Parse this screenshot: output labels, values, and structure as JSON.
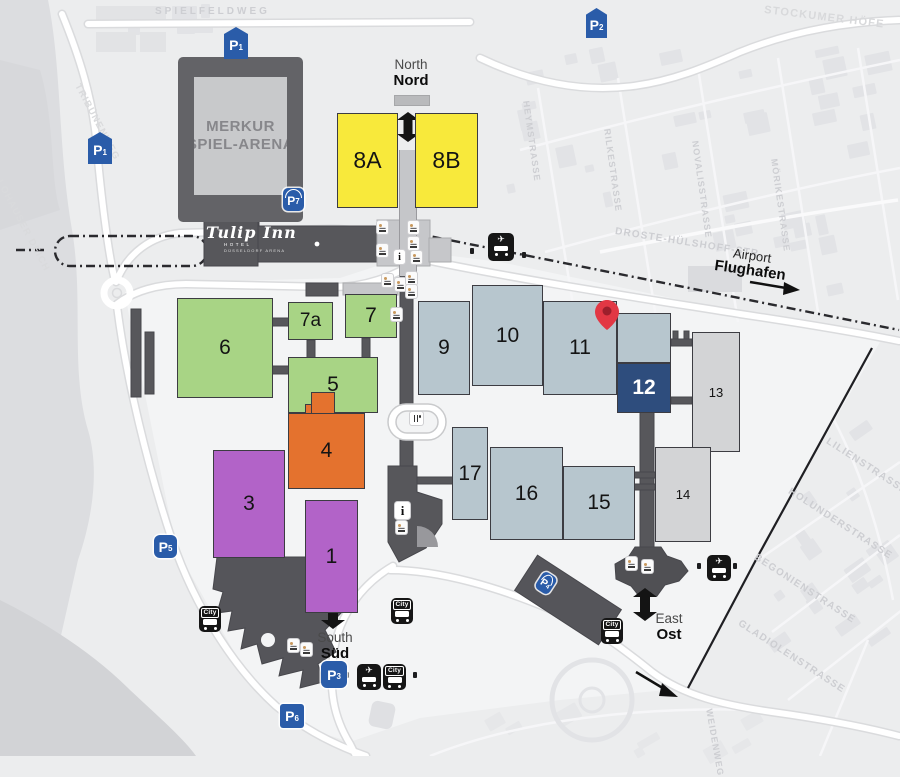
{
  "arena": {
    "line1": "MERKUR",
    "line2": "SPIEL-ARENA"
  },
  "hotel": {
    "name": "Tulip Inn",
    "line2": "HOTEL",
    "line3": "DÜSSELDORF ARENA"
  },
  "entrances": {
    "north": {
      "en": "North",
      "de": "Nord"
    },
    "south": {
      "en": "South",
      "de": "Süd"
    },
    "east": {
      "en": "East",
      "de": "Ost"
    }
  },
  "airport": {
    "en": "Airport",
    "de": "Flughafen"
  },
  "halls": [
    {
      "id": "hall-1",
      "label": "1",
      "color": "purple"
    },
    {
      "id": "hall-3",
      "label": "3",
      "color": "purple"
    },
    {
      "id": "hall-4",
      "label": "4",
      "color": "orange"
    },
    {
      "id": "hall-5",
      "label": "5",
      "color": "green"
    },
    {
      "id": "hall-6",
      "label": "6",
      "color": "green"
    },
    {
      "id": "hall-7",
      "label": "7",
      "color": "green"
    },
    {
      "id": "hall-7a",
      "label": "7a",
      "color": "green"
    },
    {
      "id": "hall-8A",
      "label": "8A",
      "color": "yellow"
    },
    {
      "id": "hall-8B",
      "label": "8B",
      "color": "yellow"
    },
    {
      "id": "hall-9",
      "label": "9",
      "color": "blue"
    },
    {
      "id": "hall-10",
      "label": "10",
      "color": "blue"
    },
    {
      "id": "hall-11",
      "label": "11",
      "color": "blue"
    },
    {
      "id": "hall-12",
      "label": "12",
      "color": "navy"
    },
    {
      "id": "hall-13",
      "label": "13",
      "color": "gray"
    },
    {
      "id": "hall-14",
      "label": "14",
      "color": "gray"
    },
    {
      "id": "hall-15",
      "label": "15",
      "color": "blue"
    },
    {
      "id": "hall-16",
      "label": "16",
      "color": "blue"
    },
    {
      "id": "hall-17",
      "label": "17",
      "color": "blue"
    }
  ],
  "hall_palette": {
    "purple": "#b263c8",
    "green": "#a8d485",
    "orange": "#e4722e",
    "yellow": "#f8e93b",
    "blue": "#b7c6ce",
    "navy": "#2e4d7d",
    "gray": "#d3d4d6"
  },
  "parking": [
    {
      "id": "P1-north",
      "label": "P",
      "sub": "1"
    },
    {
      "id": "P1-west",
      "label": "P",
      "sub": "1"
    },
    {
      "id": "P2",
      "label": "P",
      "sub": "2"
    },
    {
      "id": "P3",
      "label": "P",
      "sub": "3"
    },
    {
      "id": "P5",
      "label": "P",
      "sub": "5"
    },
    {
      "id": "P6",
      "label": "P",
      "sub": "6"
    },
    {
      "id": "P7",
      "label": "P",
      "sub": "7"
    },
    {
      "id": "P4-garage",
      "label": "P",
      "sub": "4"
    }
  ],
  "transit": {
    "city_label": "City",
    "plane_glyph": "✈"
  },
  "info_label": "i",
  "streets": [
    {
      "name": "SPIELFELDWEG"
    },
    {
      "name": "STOCKUMER HÖFE"
    },
    {
      "name": "HEYMSTRASSE"
    },
    {
      "name": "RILKESTRASSE"
    },
    {
      "name": "NOVALISSTRASSE"
    },
    {
      "name": "MÖRIKESTRASSE"
    },
    {
      "name": "DROSTE-HÜLSHOFF-STR."
    },
    {
      "name": "LILIENSTRASSE"
    },
    {
      "name": "HOLUNDERSTRASSE"
    },
    {
      "name": "BEGONIENSTRASSE"
    },
    {
      "name": "GLADIOLENSTRASSE"
    },
    {
      "name": "LOHAUSER DEICH"
    },
    {
      "name": "TRIBÜNENWEG"
    },
    {
      "name": "WEIDENWEG"
    }
  ],
  "colors": {
    "pin": "#e23744",
    "parking_blue": "#2a5ca9",
    "rail_line": "#2a2a2e"
  }
}
